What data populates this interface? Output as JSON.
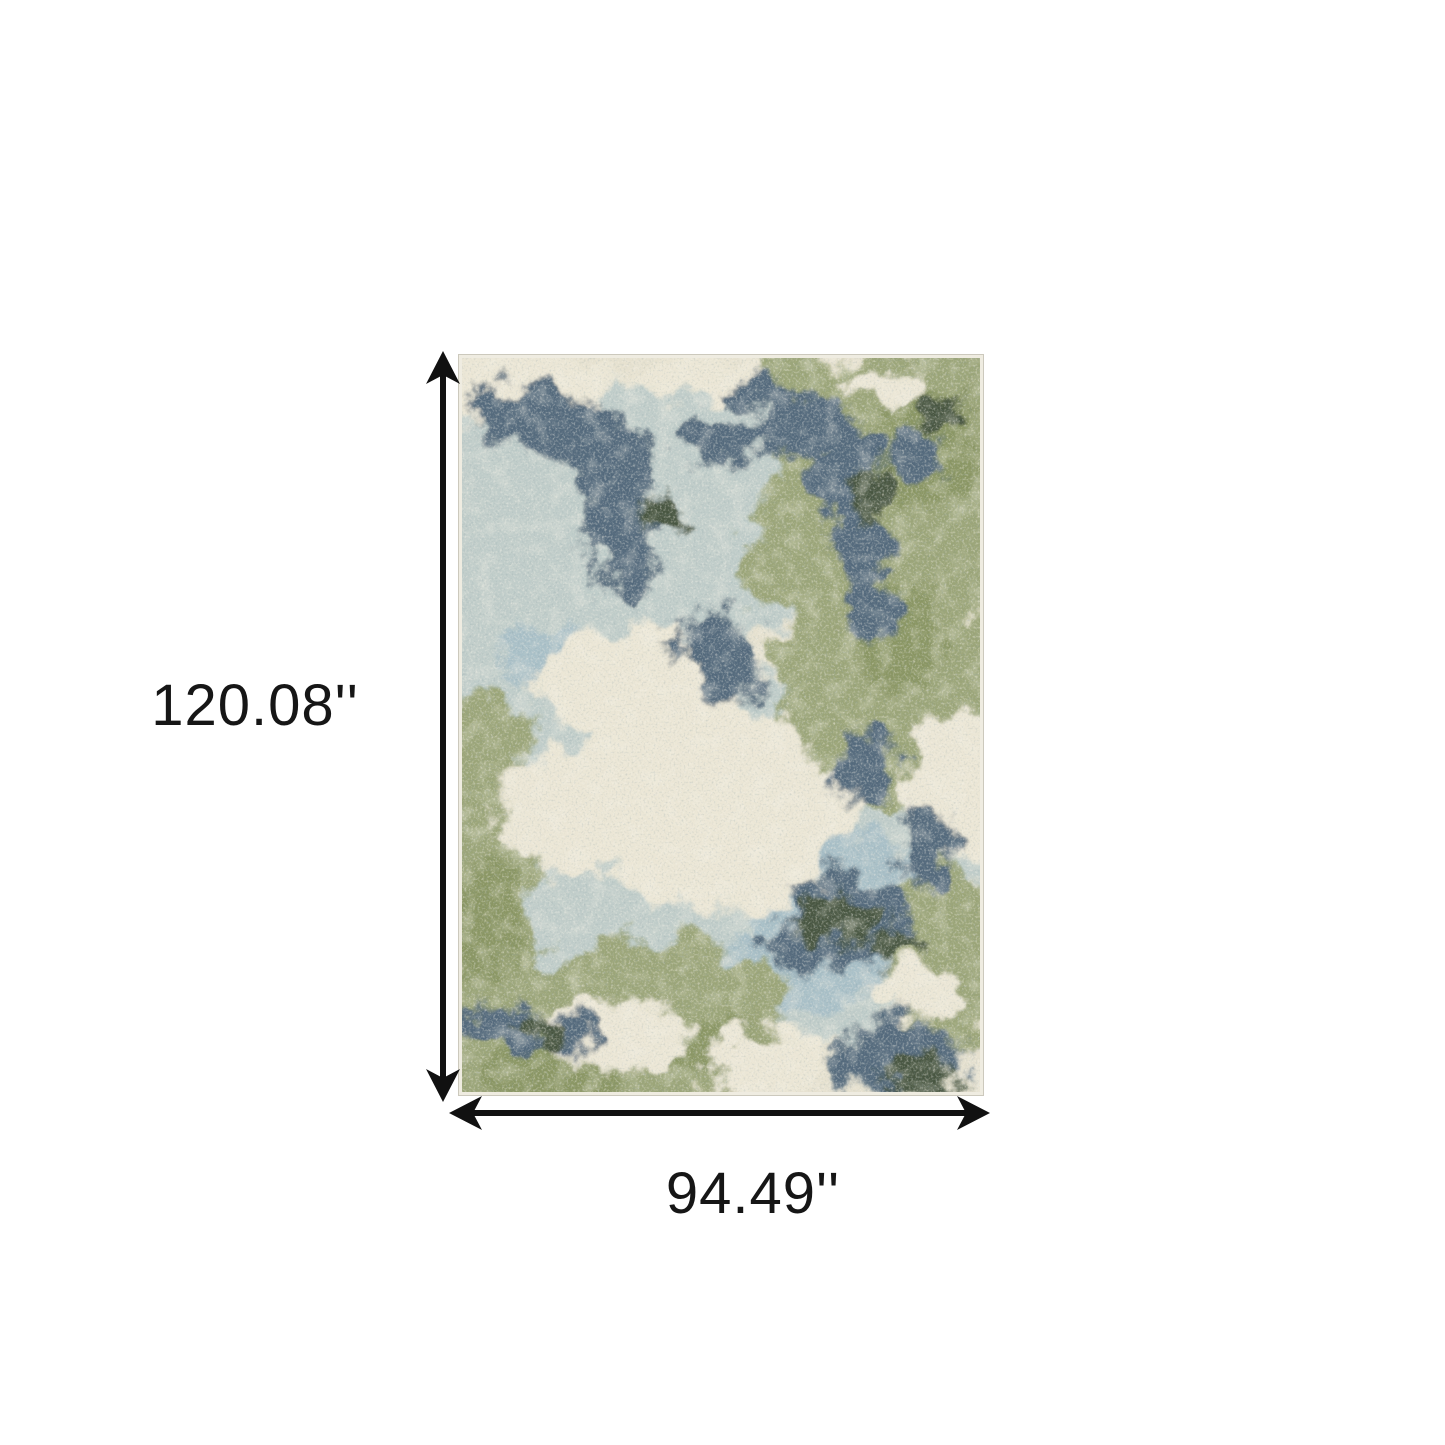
{
  "dimensions": {
    "height_label": "120.08''",
    "width_label": "94.49''"
  },
  "annotation": {
    "line_color": "#111111"
  },
  "rug": {
    "description": "abstract distressed area rug in ivory, sage green, gray-blue and slate blue",
    "palette": {
      "base_cream": "#e7e2d0",
      "cream_highlight": "#ece7d6",
      "tan": "#cfc8af",
      "pale_blue": "#c0cdca",
      "light_blue": "#a9c0c8",
      "sage_green": "#9ba578",
      "deep_green": "#8a9663",
      "steel_blue": "#52697b",
      "dark_teal": "#47553f",
      "edge": "#efece1"
    }
  }
}
